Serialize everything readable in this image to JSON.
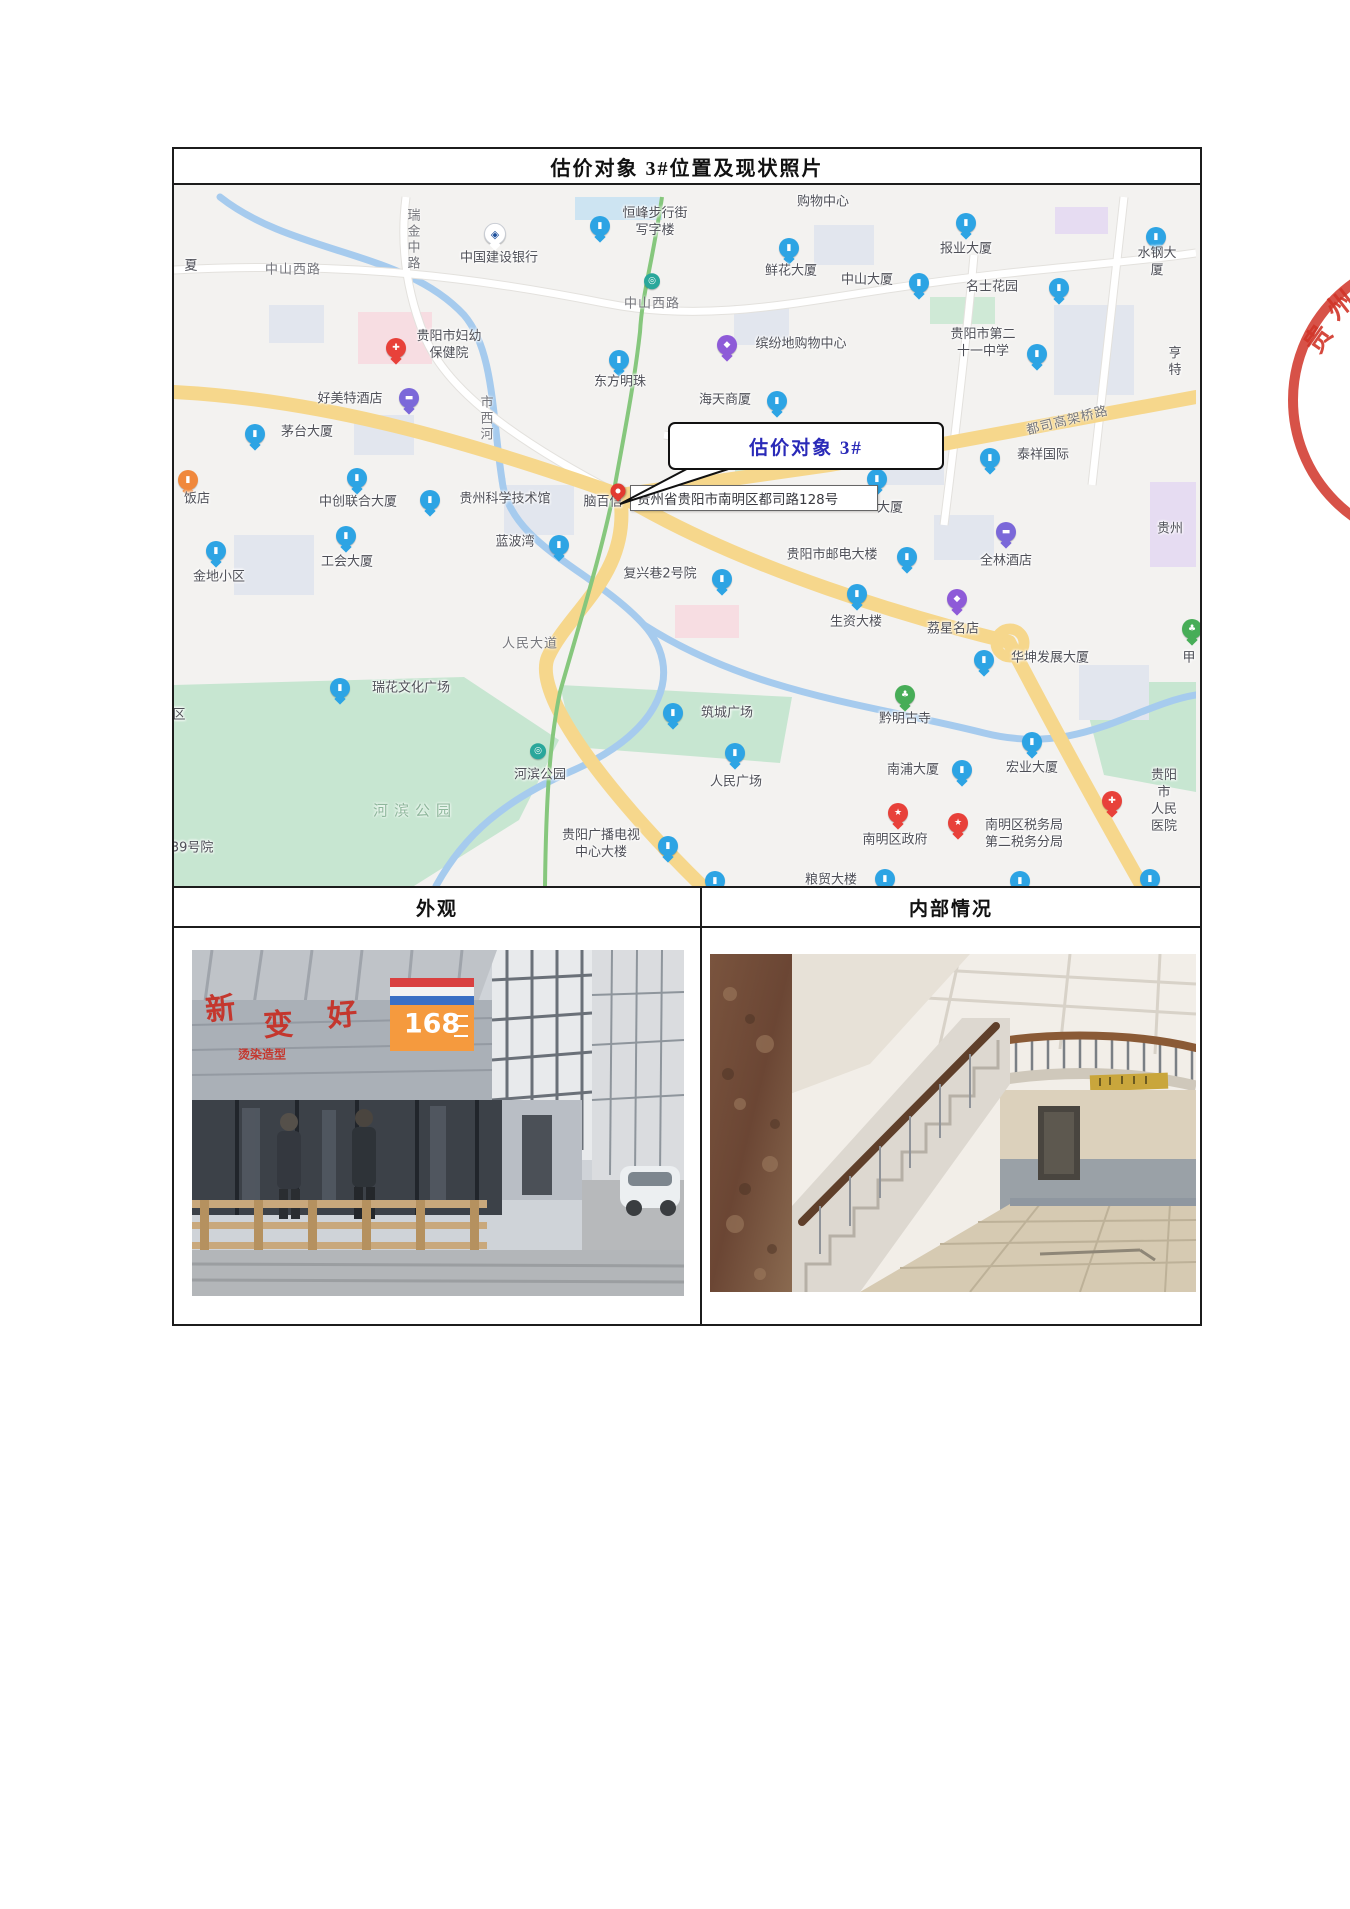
{
  "page": {
    "title": "估价对象 3#位置及现状照片"
  },
  "section_headers": {
    "exterior": "外观",
    "interior": "内部情况"
  },
  "map": {
    "callout": {
      "text": "估价对象 3#",
      "text_color": "#2a2ab8"
    },
    "address_box": {
      "text": "贵州省贵阳市南明区都司路128号"
    },
    "road_labels": [
      {
        "t": "中山西路",
        "x": 119,
        "y": 83
      },
      {
        "t": "中山西路",
        "x": 478,
        "y": 117
      },
      {
        "t": "瑞金中路",
        "x": 238,
        "y": 55,
        "v": 1
      },
      {
        "t": "市西河",
        "x": 311,
        "y": 234,
        "v": 1
      },
      {
        "t": "人民大道",
        "x": 356,
        "y": 457
      },
      {
        "t": "都司高架桥路",
        "x": 893,
        "y": 234,
        "r": -14
      },
      {
        "t": "河滨公园",
        "x": 241,
        "y": 625,
        "park": 1
      }
    ],
    "labels": [
      {
        "t": "夏",
        "x": 17,
        "y": 82
      },
      {
        "t": "中国建设银行",
        "x": 325,
        "y": 74,
        "i": "k",
        "ix": 321,
        "iy": 50
      },
      {
        "t": "恒峰步行街\n写字楼",
        "x": 481,
        "y": 38,
        "i": "b",
        "ix": 426,
        "iy": 42
      },
      {
        "t": "购物中心",
        "x": 649,
        "y": 18
      },
      {
        "t": "报业大厦",
        "x": 792,
        "y": 65,
        "i": "b",
        "ix": 792,
        "iy": 39
      },
      {
        "t": "水钢大厦",
        "x": 983,
        "y": 78,
        "i": "b",
        "ix": 982,
        "iy": 53
      },
      {
        "t": "鲜花大厦",
        "x": 617,
        "y": 87,
        "i": "b",
        "ix": 615,
        "iy": 64
      },
      {
        "t": "中山大厦",
        "x": 693,
        "y": 96,
        "i": "b",
        "ix": 745,
        "iy": 99
      },
      {
        "t": "名士花园",
        "x": 818,
        "y": 103,
        "i": "b",
        "ix": 885,
        "iy": 104
      },
      {
        "t": "贵阳市第二\n十一中学",
        "x": 809,
        "y": 159,
        "i": "b",
        "ix": 863,
        "iy": 170
      },
      {
        "t": "亨特",
        "x": 1001,
        "y": 178
      },
      {
        "t": "贵阳市妇幼\n保健院",
        "x": 275,
        "y": 161,
        "i": "r",
        "ix": 222,
        "iy": 164
      },
      {
        "t": "好美特酒店",
        "x": 176,
        "y": 215,
        "i": "h",
        "ix": 235,
        "iy": 214
      },
      {
        "t": "东方明珠",
        "x": 446,
        "y": 198,
        "i": "b",
        "ix": 445,
        "iy": 176
      },
      {
        "t": "缤纷地购物中心",
        "x": 627,
        "y": 160,
        "i": "p",
        "ix": 553,
        "iy": 161
      },
      {
        "t": "海天商厦",
        "x": 551,
        "y": 216,
        "i": "b",
        "ix": 603,
        "iy": 217
      },
      {
        "t": "茅台大厦",
        "x": 133,
        "y": 248,
        "i": "b",
        "ix": 81,
        "iy": 250
      },
      {
        "t": "泰祥国际",
        "x": 869,
        "y": 271,
        "i": "b",
        "ix": 816,
        "iy": 274
      },
      {
        "t": "饭店",
        "x": 23,
        "y": 315,
        "i": "o",
        "ix": 14,
        "iy": 296
      },
      {
        "t": "中创联合大厦",
        "x": 184,
        "y": 318,
        "i": "b",
        "ix": 183,
        "iy": 294
      },
      {
        "t": "贵州科学技术馆",
        "x": 331,
        "y": 315,
        "i": "b",
        "ix": 256,
        "iy": 316
      },
      {
        "t": "脑百信",
        "x": 429,
        "y": 318
      },
      {
        "t": "大厦",
        "x": 716,
        "y": 324,
        "i": "b",
        "ix": 703,
        "iy": 295
      },
      {
        "t": "金地小区",
        "x": 45,
        "y": 393,
        "i": "b",
        "ix": 42,
        "iy": 367
      },
      {
        "t": "工会大厦",
        "x": 173,
        "y": 378,
        "i": "b",
        "ix": 172,
        "iy": 352
      },
      {
        "t": "蓝波湾",
        "x": 341,
        "y": 358,
        "i": "b",
        "ix": 385,
        "iy": 361
      },
      {
        "t": "复兴巷2号院",
        "x": 486,
        "y": 390,
        "i": "b",
        "ix": 548,
        "iy": 395
      },
      {
        "t": "贵阳市邮电大楼",
        "x": 658,
        "y": 371,
        "i": "b",
        "ix": 733,
        "iy": 373
      },
      {
        "t": "全林酒店",
        "x": 832,
        "y": 377,
        "i": "h",
        "ix": 832,
        "iy": 348
      },
      {
        "t": "贵州",
        "x": 996,
        "y": 345
      },
      {
        "t": "生资大楼",
        "x": 682,
        "y": 438,
        "i": "b",
        "ix": 683,
        "iy": 410
      },
      {
        "t": "荔星名店",
        "x": 779,
        "y": 445,
        "i": "p",
        "ix": 783,
        "iy": 415
      },
      {
        "t": "华坤发展大厦",
        "x": 876,
        "y": 474,
        "i": "b",
        "ix": 810,
        "iy": 476
      },
      {
        "t": "甲",
        "x": 1015,
        "y": 474,
        "i": "t",
        "ix": 1018,
        "iy": 445
      },
      {
        "t": "黔明古寺",
        "x": 731,
        "y": 535,
        "i": "t",
        "ix": 731,
        "iy": 511
      },
      {
        "t": "筑城广场",
        "x": 553,
        "y": 529,
        "i": "b",
        "ix": 499,
        "iy": 529
      },
      {
        "t": "瑞花文化广场",
        "x": 237,
        "y": 504,
        "i": "b",
        "ix": 166,
        "iy": 504
      },
      {
        "t": "河滨公园",
        "x": 366,
        "y": 591,
        "i": "m",
        "ix": 364,
        "iy": 567
      },
      {
        "t": "人民广场",
        "x": 562,
        "y": 598,
        "i": "b",
        "ix": 561,
        "iy": 569
      },
      {
        "t": "南浦大厦",
        "x": 739,
        "y": 586,
        "i": "b",
        "ix": 788,
        "iy": 586
      },
      {
        "t": "宏业大厦",
        "x": 858,
        "y": 584,
        "i": "b",
        "ix": 858,
        "iy": 558
      },
      {
        "t": "贵阳市\n人民医院",
        "x": 990,
        "y": 617,
        "i": "r",
        "ix": 938,
        "iy": 617
      },
      {
        "t": "南明区政府",
        "x": 721,
        "y": 656,
        "i": "g",
        "ix": 724,
        "iy": 629
      },
      {
        "t": "南明区税务局\n第二税务分局",
        "x": 850,
        "y": 650,
        "i": "g",
        "ix": 784,
        "iy": 639
      },
      {
        "t": "贵阳广播电视\n中心大楼",
        "x": 427,
        "y": 660,
        "i": "b",
        "ix": 494,
        "iy": 662
      },
      {
        "t": "139号院",
        "x": 14,
        "y": 664
      },
      {
        "t": "粮贸大楼",
        "x": 657,
        "y": 696
      },
      {
        "t": "区",
        "x": 5,
        "y": 531
      },
      {
        "t": "",
        "i": "m",
        "ix": 478,
        "iy": 97
      },
      {
        "t": "",
        "i": "b",
        "ix": 541,
        "iy": 697
      },
      {
        "t": "",
        "i": "b",
        "ix": 711,
        "iy": 695
      },
      {
        "t": "",
        "i": "b",
        "ix": 846,
        "iy": 697
      },
      {
        "t": "",
        "i": "b",
        "ix": 976,
        "iy": 695
      }
    ],
    "icon_glyphs": {
      "b": "▮",
      "p": "◆",
      "h": "▬",
      "r": "✚",
      "g": "★",
      "t": "♣",
      "k": "◈",
      "o": "▮",
      "m": "◎"
    },
    "colors": {
      "road_yellow": "#f6d78c",
      "river": "#a6cbee",
      "park": "#cbe8d3",
      "metro_line": "#86c77d",
      "bg": "#f3f2f0"
    }
  },
  "stamp": {
    "text": "贵州",
    "chars": [
      "贵",
      "州"
    ],
    "color": "#d03428"
  },
  "photos": {
    "exterior": {
      "overlays": [
        {
          "t": "新",
          "x": 28,
          "y": 56,
          "s": 30,
          "c": "#c4372e",
          "r": -6
        },
        {
          "t": "变",
          "x": 86,
          "y": 72,
          "s": 30,
          "c": "#c4372e",
          "r": -3
        },
        {
          "t": "好",
          "x": 150,
          "y": 62,
          "s": 30,
          "c": "#c4372e",
          "r": -5
        },
        {
          "t": "烫染造型",
          "x": 70,
          "y": 104,
          "s": 12,
          "c": "#c4372e",
          "r": 0
        },
        {
          "t": "168",
          "x": 240,
          "y": 74,
          "s": 27,
          "c": "#ffffff",
          "r": 0
        }
      ]
    },
    "interior": {
      "overlays": []
    }
  }
}
